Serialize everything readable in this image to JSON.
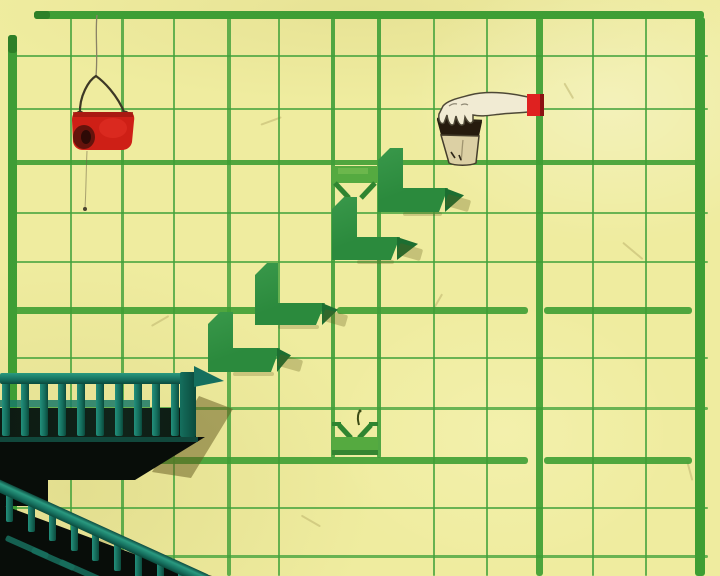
{
  "scene": {
    "name": "hand-painted-wall-scene",
    "width": 720,
    "height": 576,
    "palette": {
      "paper": "#efec9f",
      "paper_light": "#f6f3ae",
      "paper_shade": "rgba(170,160,70,0.18)",
      "grid_thin": "#44a33c",
      "grid_medium": "#3f9f38",
      "grid_thick": "#3e9e33",
      "border_green": "#3f9d36",
      "border_cap": "#2c7c27",
      "step_green_light": "#39984a",
      "step_green": "#2b8a3d",
      "step_wedge": "#1c6e31",
      "socket_band": "#55aa40",
      "socket_notch": "#2f8530",
      "teal_bright": "#23907c",
      "teal_mid": "#156f5e",
      "teal_dark": "#0b4a3c",
      "ink_black": "#080d09",
      "wall_shadow": "rgba(97,88,30,0.5)",
      "bucket_red": "#ce1f16",
      "bucket_dark": "#5c120c",
      "sleeve_red": "#df2120",
      "cup_fill": "#dcd0a4",
      "cup_contents": "#261b0e",
      "arm_fill": "#f1ebd3",
      "outline": "#4e4836",
      "string": "#8a8266"
    }
  },
  "grid": {
    "v_lines": [
      {
        "x": 70,
        "w": 2
      },
      {
        "x": 121,
        "w": 3
      },
      {
        "x": 173,
        "w": 2
      },
      {
        "x": 227,
        "w": 4
      },
      {
        "x": 278,
        "w": 2
      },
      {
        "x": 433,
        "w": 2
      },
      {
        "x": 486,
        "w": 2
      },
      {
        "x": 592,
        "w": 2
      },
      {
        "x": 645,
        "w": 2
      }
    ],
    "v_channel": [
      {
        "x": 331,
        "w": 4
      },
      {
        "x": 377,
        "w": 4
      }
    ],
    "v_thick": [
      {
        "x": 536,
        "w": 7
      }
    ],
    "h_lines": [
      {
        "y": 55,
        "h": 2
      },
      {
        "y": 108,
        "h": 2
      },
      {
        "y": 212,
        "h": 2
      },
      {
        "y": 261,
        "h": 2
      },
      {
        "y": 357,
        "h": 2
      },
      {
        "y": 407,
        "h": 3
      },
      {
        "y": 507,
        "h": 2
      },
      {
        "y": 555,
        "h": 3
      }
    ],
    "h_thick": [
      {
        "y": 160,
        "h": 5,
        "segs": [
          [
            10,
            705
          ]
        ]
      },
      {
        "y": 307,
        "h": 7,
        "segs": [
          [
            10,
            330
          ],
          [
            337,
            528
          ],
          [
            544,
            692
          ]
        ]
      },
      {
        "y": 457,
        "h": 7,
        "segs": [
          [
            152,
            528
          ],
          [
            544,
            692
          ]
        ]
      }
    ],
    "borders": {
      "top": {
        "x": 34,
        "y": 11,
        "w": 670,
        "h": 8
      },
      "left": {
        "x": 8,
        "y": 35,
        "w": 9,
        "h": 541
      },
      "right": {
        "x": 695,
        "y": 17,
        "w": 10,
        "h": 559
      },
      "caps": [
        {
          "x": 34,
          "y": 11,
          "w": 16,
          "h": 8
        },
        {
          "x": 8,
          "y": 35,
          "w": 9,
          "h": 18
        }
      ]
    },
    "fibers": [
      {
        "x": 620,
        "y": 250,
        "len": 26,
        "a": 40
      },
      {
        "x": 150,
        "y": 320,
        "len": 20,
        "a": -30
      },
      {
        "x": 90,
        "y": 540,
        "len": 24,
        "a": 15
      },
      {
        "x": 560,
        "y": 90,
        "len": 18,
        "a": 60
      },
      {
        "x": 260,
        "y": 120,
        "len": 22,
        "a": -20
      },
      {
        "x": 680,
        "y": 470,
        "len": 20,
        "a": 75
      },
      {
        "x": 430,
        "y": 300,
        "len": 16,
        "a": -60
      },
      {
        "x": 300,
        "y": 520,
        "len": 22,
        "a": 30
      }
    ]
  },
  "channel": {
    "name": "step-dispenser-channel",
    "rail_y1": 14,
    "rail_y2": 458,
    "top_socket": {
      "x": 326,
      "y": 162
    },
    "bottom_socket": {
      "x": 326,
      "y": 408
    }
  },
  "steps": {
    "name": "floating-step-block",
    "items": [
      {
        "x": 208,
        "y": 312,
        "w": 72,
        "h": 60,
        "vw": 25,
        "hh": 24,
        "wedge": 10
      },
      {
        "x": 255,
        "y": 263,
        "w": 70,
        "h": 62,
        "vw": 23,
        "hh": 22,
        "wedge": 12
      },
      {
        "x": 332,
        "y": 197,
        "w": 68,
        "h": 63,
        "vw": 25,
        "hh": 23,
        "wedge": 17
      },
      {
        "x": 378,
        "y": 148,
        "w": 70,
        "h": 64,
        "vw": 25,
        "hh": 24,
        "wedge": 15
      }
    ]
  },
  "bucket": {
    "name": "hanging-red-bucket",
    "x": 55,
    "y": 8,
    "w": 90,
    "h": 215
  },
  "pour": {
    "name": "pouring-hand-with-cup",
    "x": 415,
    "y": 78,
    "w": 130,
    "h": 100
  },
  "balcony": {
    "name": "fire-escape-balcony",
    "rail": {
      "x": 0,
      "y": 373,
      "w": 197,
      "h": 11
    },
    "post": {
      "x": 180,
      "y": 372,
      "w": 16,
      "h": 65
    },
    "balusters": {
      "count": 10,
      "x0": 2,
      "dx": 18.8,
      "w": 8,
      "y": 377,
      "h": 59
    },
    "midrail": {
      "x": 0,
      "y": 400,
      "w": 150,
      "h": 7
    },
    "band": {
      "x": 0,
      "y": 408,
      "w": 196,
      "h": 29
    },
    "deck_points": "0px 437px, 205px 437px, 135px 480px, 0px 480px",
    "shadow_points": "199px 396px, 233px 409px, 191px 478px, 152px 472px",
    "rail_end_wedge": "194px 366px, 224px 381px, 194px 387px",
    "under_block": {
      "x": 0,
      "y": 478,
      "w": 48,
      "h": 28
    }
  },
  "stairs": {
    "name": "fire-escape-stairs",
    "rail": {
      "x": -8,
      "y": 476,
      "len": 240,
      "h": 12,
      "angle": 24.5
    },
    "balusters": {
      "count": 9,
      "x0": 6,
      "dx": 21.5,
      "w": 7,
      "h": 30,
      "y0": 489,
      "slope": 0.456
    },
    "mass": {
      "x": 0,
      "y": 496,
      "w": 212,
      "h": 80,
      "points": "0px 8px, 150px 64px, 212px 80px, 0px 80px"
    },
    "treads": [
      {
        "x": 4,
        "y": 544
      },
      {
        "x": 30,
        "y": 556
      },
      {
        "x": 58,
        "y": 568
      }
    ]
  }
}
